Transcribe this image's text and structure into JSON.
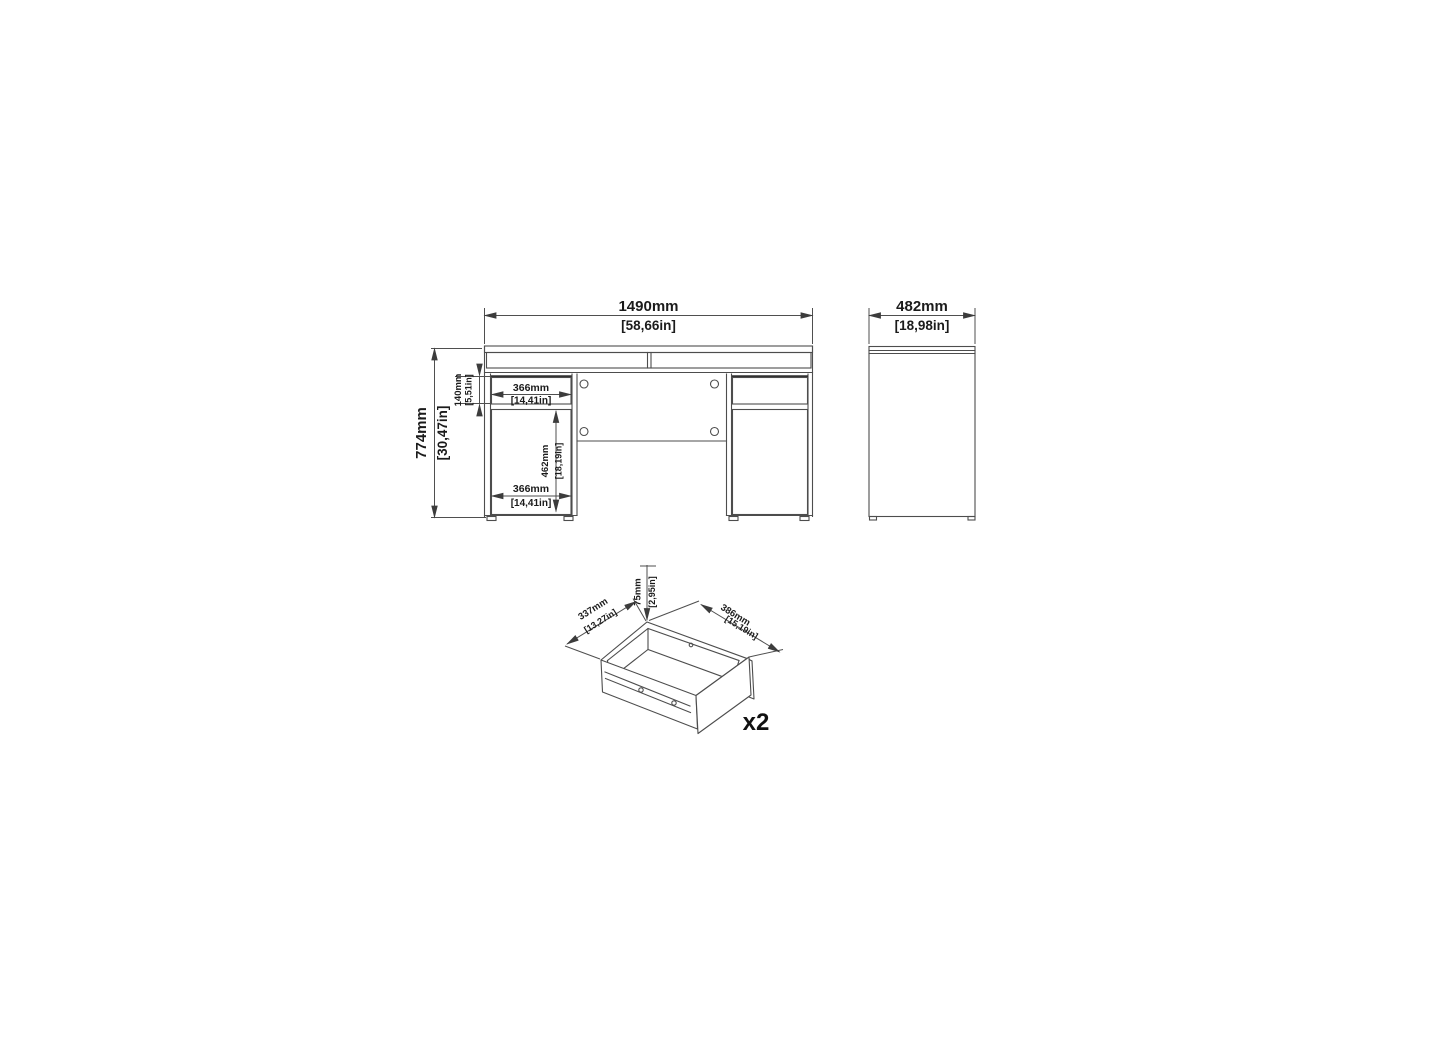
{
  "document_type": "furniture-dimension-drawing",
  "views": {
    "front": {
      "overall_width": {
        "mm": "1490mm",
        "in": "[58,66in]"
      },
      "overall_height": {
        "mm": "774mm",
        "in": "[30,47in]"
      },
      "drawer_height": {
        "mm": "140mm",
        "in": "[5,51in]"
      },
      "drawer_width": {
        "mm": "366mm",
        "in": "[14,41in]"
      },
      "door_height": {
        "mm": "462mm",
        "in": "[18,19in]"
      },
      "door_width": {
        "mm": "366mm",
        "in": "[14,41in]"
      }
    },
    "side": {
      "overall_depth": {
        "mm": "482mm",
        "in": "[18,98in]"
      }
    },
    "drawer": {
      "height": {
        "mm": "75mm",
        "in": "[2,95in]"
      },
      "depth": {
        "mm": "337mm",
        "in": "[13,27in]"
      },
      "width": {
        "mm": "386mm",
        "in": "[15,19in]"
      },
      "quantity_label": "x2"
    }
  },
  "colors": {
    "background": "#ffffff",
    "line": "#4d4d4d",
    "thick_line": "#303030",
    "text": "#1b1b1b"
  }
}
